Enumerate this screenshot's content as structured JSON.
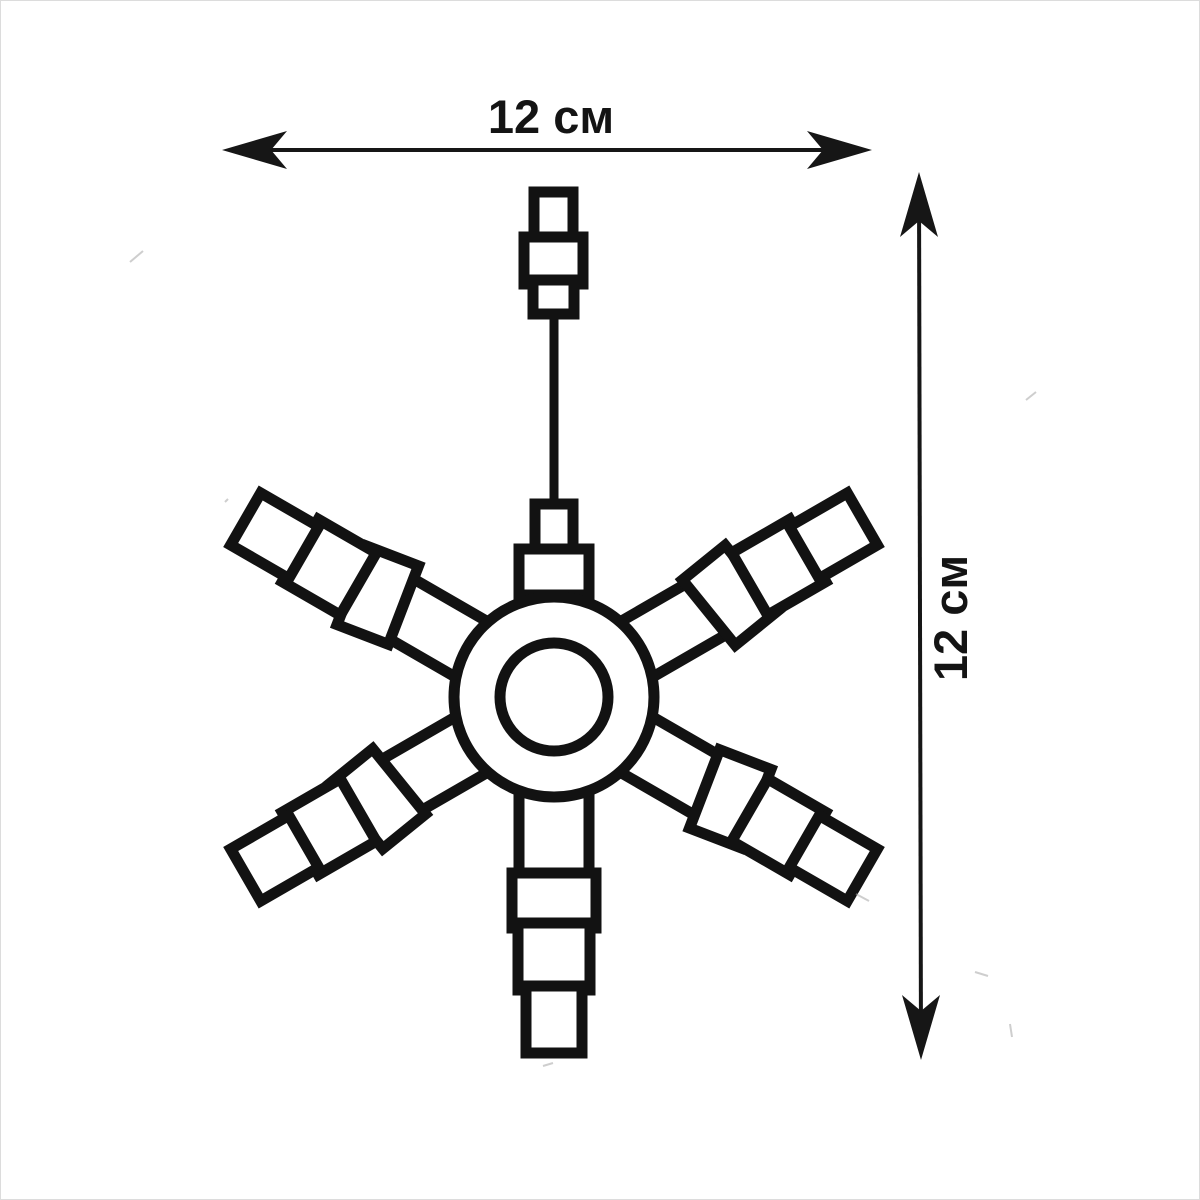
{
  "page": {
    "background": "#ffffff",
    "ink": "#141414",
    "artifact_color": "#a6a6a6"
  },
  "dimensions": {
    "horizontal": {
      "label": "12 см",
      "value": "12",
      "unit": "см"
    },
    "vertical": {
      "label": "12 см",
      "value": "12",
      "unit": "см"
    }
  },
  "figure": {
    "description": "Outline drawing of a six-arm snowflake light with segmented arms, central ring hub, hanging wire and plug connector"
  }
}
